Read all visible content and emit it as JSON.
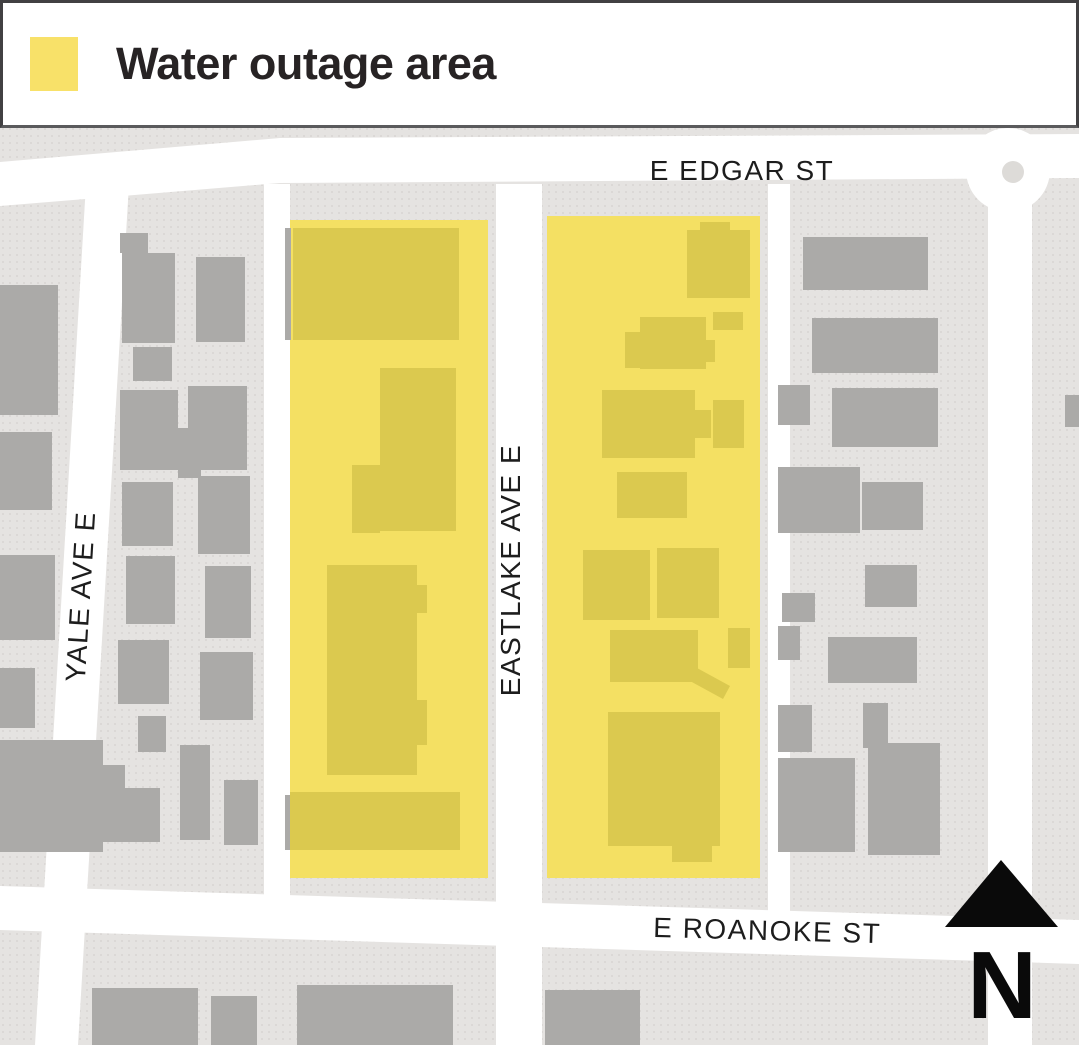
{
  "legend": {
    "label": "Water outage area",
    "swatch_color": "#f8e169"
  },
  "colors": {
    "map_bg": "#e5e3e1",
    "dot": "#d8d5d2",
    "street": "#ffffff",
    "building": "#abaaa8",
    "outage_area": "#f4e063",
    "outage_building": "#dbc94f",
    "label": "#1d1d1d",
    "north": "#0a0a0a",
    "roundabout_dot": "#dddbd8"
  },
  "map": {
    "street_labels": [
      {
        "name": "e-edgar-st",
        "text": "E EDGAR ST",
        "tf": "translate(742 180)"
      },
      {
        "name": "yale-ave-e",
        "text": "YALE AVE E",
        "tf": "translate(90 597) rotate(-86.5)"
      },
      {
        "name": "eastlake-ave-e",
        "text": "EASTLAKE AVE E",
        "tf": "translate(520 570) rotate(-90)"
      },
      {
        "name": "e-roanoke-st",
        "text": "E ROANOKE ST",
        "tf": "translate(767 940) rotate(1.6)"
      }
    ],
    "north_label": "N",
    "north_arrow_points": "1001,860 1058,927 945,927",
    "streets": [
      {
        "name": "e-edgar-st",
        "points": "0,162 280,138 1079,134 1079,178 280,183 0,206"
      },
      {
        "name": "e-roanoke-st",
        "points": "0,886 1079,920 1079,964 0,930"
      },
      {
        "name": "yale-ave-e",
        "points": "86,184 129,184 78,1045 35,1045"
      },
      {
        "name": "alley-west",
        "points": "264,184 290,184 290,916 264,916"
      },
      {
        "name": "eastlake-ave-e",
        "points": "496,184 542,184 542,1045 496,1045"
      },
      {
        "name": "alley-east",
        "points": "768,184 790,184 790,918 768,918"
      },
      {
        "name": "street-far-right",
        "points": "988,196 1032,196 1032,1045 988,1045"
      }
    ],
    "roundabout": {
      "cx": 1008,
      "cy": 170,
      "r": 42,
      "dot_cx": 1013,
      "dot_cy": 172,
      "dot_r": 11
    },
    "outage_areas": [
      [
        290,
        220,
        198,
        658
      ],
      [
        547,
        216,
        213,
        662
      ]
    ],
    "buildings_gray": [
      [
        0,
        285,
        58,
        130
      ],
      [
        0,
        432,
        52,
        78
      ],
      [
        0,
        555,
        55,
        85
      ],
      [
        0,
        668,
        35,
        60
      ],
      [
        0,
        740,
        103,
        112
      ],
      [
        103,
        765,
        22,
        28
      ],
      [
        120,
        233,
        28,
        20
      ],
      [
        122,
        253,
        53,
        90
      ],
      [
        196,
        257,
        49,
        85
      ],
      [
        133,
        347,
        39,
        34
      ],
      [
        120,
        390,
        58,
        80
      ],
      [
        188,
        386,
        59,
        84
      ],
      [
        178,
        428,
        23,
        50
      ],
      [
        122,
        482,
        51,
        64
      ],
      [
        198,
        476,
        52,
        78
      ],
      [
        126,
        556,
        49,
        68
      ],
      [
        205,
        566,
        46,
        72
      ],
      [
        118,
        640,
        51,
        64
      ],
      [
        200,
        652,
        53,
        68
      ],
      [
        138,
        716,
        28,
        36
      ],
      [
        180,
        745,
        30,
        95
      ],
      [
        95,
        788,
        65,
        54
      ],
      [
        224,
        780,
        34,
        65
      ],
      [
        285,
        228,
        6,
        112
      ],
      [
        285,
        795,
        6,
        55
      ],
      [
        803,
        237,
        125,
        53
      ],
      [
        812,
        318,
        126,
        55
      ],
      [
        778,
        385,
        32,
        40
      ],
      [
        832,
        388,
        106,
        59
      ],
      [
        778,
        467,
        82,
        66
      ],
      [
        862,
        482,
        61,
        48
      ],
      [
        865,
        565,
        52,
        42
      ],
      [
        782,
        593,
        33,
        29
      ],
      [
        778,
        626,
        22,
        34
      ],
      [
        828,
        637,
        89,
        46
      ],
      [
        778,
        705,
        34,
        47
      ],
      [
        863,
        703,
        25,
        45
      ],
      [
        868,
        743,
        72,
        112
      ],
      [
        778,
        758,
        77,
        94
      ],
      [
        1065,
        395,
        14,
        32
      ],
      [
        92,
        988,
        106,
        57
      ],
      [
        211,
        996,
        46,
        49
      ],
      [
        297,
        985,
        156,
        60
      ],
      [
        545,
        990,
        95,
        55
      ]
    ],
    "buildings_outage": [
      [
        293,
        228,
        166,
        112
      ],
      [
        380,
        368,
        76,
        163
      ],
      [
        352,
        465,
        28,
        68
      ],
      [
        327,
        565,
        90,
        210
      ],
      [
        415,
        585,
        12,
        28
      ],
      [
        415,
        700,
        12,
        45
      ],
      [
        290,
        792,
        170,
        58
      ],
      [
        700,
        222,
        30,
        10
      ],
      [
        687,
        230,
        63,
        68
      ],
      [
        713,
        312,
        30,
        18
      ],
      [
        640,
        317,
        66,
        52
      ],
      [
        625,
        332,
        18,
        36
      ],
      [
        705,
        340,
        10,
        22
      ],
      [
        602,
        390,
        93,
        68
      ],
      [
        695,
        410,
        16,
        28
      ],
      [
        713,
        400,
        31,
        48
      ],
      [
        617,
        472,
        70,
        46
      ],
      [
        583,
        550,
        67,
        70
      ],
      [
        657,
        548,
        62,
        70
      ],
      [
        610,
        630,
        88,
        52
      ],
      [
        728,
        628,
        22,
        40
      ],
      [
        608,
        712,
        112,
        134
      ],
      [
        672,
        846,
        40,
        16
      ]
    ],
    "buildings_outage_polys": [
      "697,668 730,686 723,699 690,681"
    ]
  }
}
